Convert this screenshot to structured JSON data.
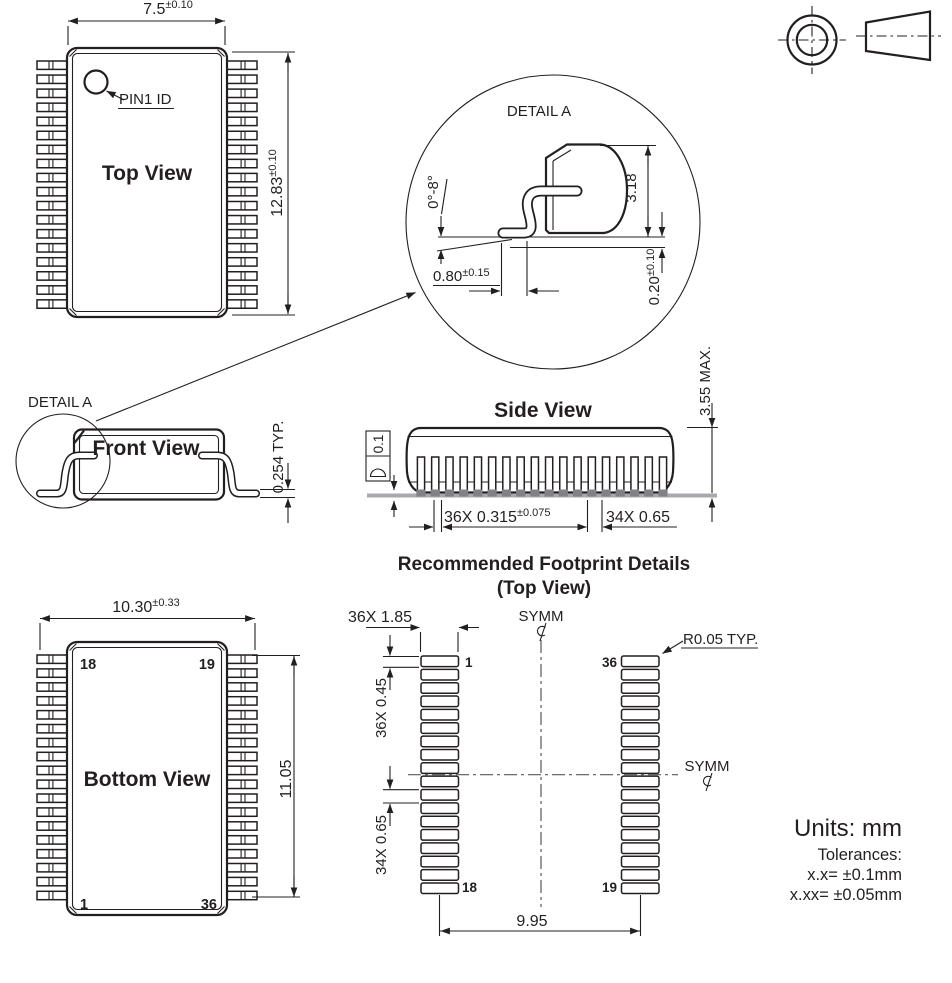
{
  "colors": {
    "line": "#231f20",
    "seating_plane": "#a7a9ac",
    "foot": "#808285",
    "background": "#ffffff"
  },
  "top_view": {
    "title": "Top View",
    "width": "7.5",
    "width_tol": "±0.10",
    "length": "12.83",
    "length_tol": "±0.10",
    "pin1_label": "PIN1 ID"
  },
  "detail_a": {
    "label": "DETAIL A",
    "lead_angle": "0°-8°",
    "body_height": "3.18",
    "foot_length": "0.80",
    "foot_length_tol": "±0.15",
    "standoff": "0.20",
    "standoff_tol": "±0.10"
  },
  "front_view": {
    "title": "Front View",
    "detail_label": "DETAIL A",
    "lead_thickness": "0.254 TYP."
  },
  "side_view": {
    "title": "Side View",
    "flatness": "0.1",
    "lead_width": "36X 0.315",
    "lead_width_tol": "±0.075",
    "lead_pitch": "34X 0.65",
    "max_height": "3.55 MAX."
  },
  "footprint": {
    "title": "Recommended Footprint Details",
    "subtitle": "(Top View)",
    "pad_length": "36X 1.85",
    "pad_width": "36X 0.45",
    "pad_pitch": "34X 0.65",
    "span": "9.95",
    "corner_radius": "R0.05 TYP.",
    "symm_top": "SYMM",
    "symm_right": "SYMM",
    "pin1": "1",
    "pin18": "18",
    "pin19": "19",
    "pin36": "36"
  },
  "bottom_view": {
    "title": "Bottom View",
    "span": "10.30",
    "span_tol": "±0.33",
    "pad_row_length": "11.05",
    "pin_top_left": "18",
    "pin_top_right": "19",
    "pin_bottom_left": "1",
    "pin_bottom_right": "36"
  },
  "notes": {
    "units": "Units: mm",
    "tolerances_title": "Tolerances:",
    "tolerance_1": "x.x= ±0.1mm",
    "tolerance_2": "x.xx= ±0.05mm"
  }
}
